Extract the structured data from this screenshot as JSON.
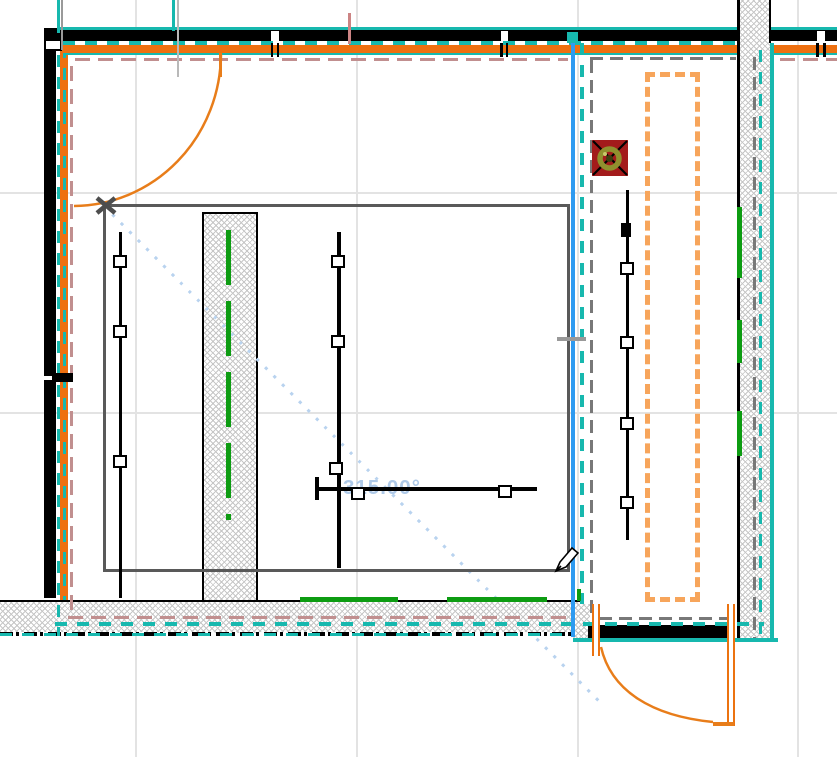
{
  "view": {
    "type": "cad-floor-plan-canvas",
    "background": "white",
    "grid_visible": true,
    "tool_cursor": "pencil"
  },
  "annotation": {
    "angle_label": "315.00°"
  },
  "colors": {
    "selection_teal": "#17b8ae",
    "wall_fill_orange": "#ee7010",
    "cabinet_orange": "#f7a55b",
    "door_orange": "#e87d1a",
    "reference_pink": "#c18f8f",
    "guide_blue": "#2e9af0",
    "trace_light_blue": "#b9d3ef",
    "wiring_green": "#0d9c12",
    "symbol_red": "#a31b1b",
    "symbol_olive": "#90902e",
    "zone_gray": "#595959"
  },
  "entities": {
    "rooms": 2,
    "doors": 2,
    "hatched_columns": 1,
    "device_runs": [
      {
        "name": "device-run-1",
        "devices": 3
      },
      {
        "name": "device-run-2",
        "devices": 3
      },
      {
        "name": "device-run-3",
        "devices": 2
      },
      {
        "name": "device-run-4",
        "devices": 4
      }
    ],
    "symbols": [
      {
        "name": "round-fixture-symbol"
      }
    ],
    "walls_selected_highlight": true
  }
}
